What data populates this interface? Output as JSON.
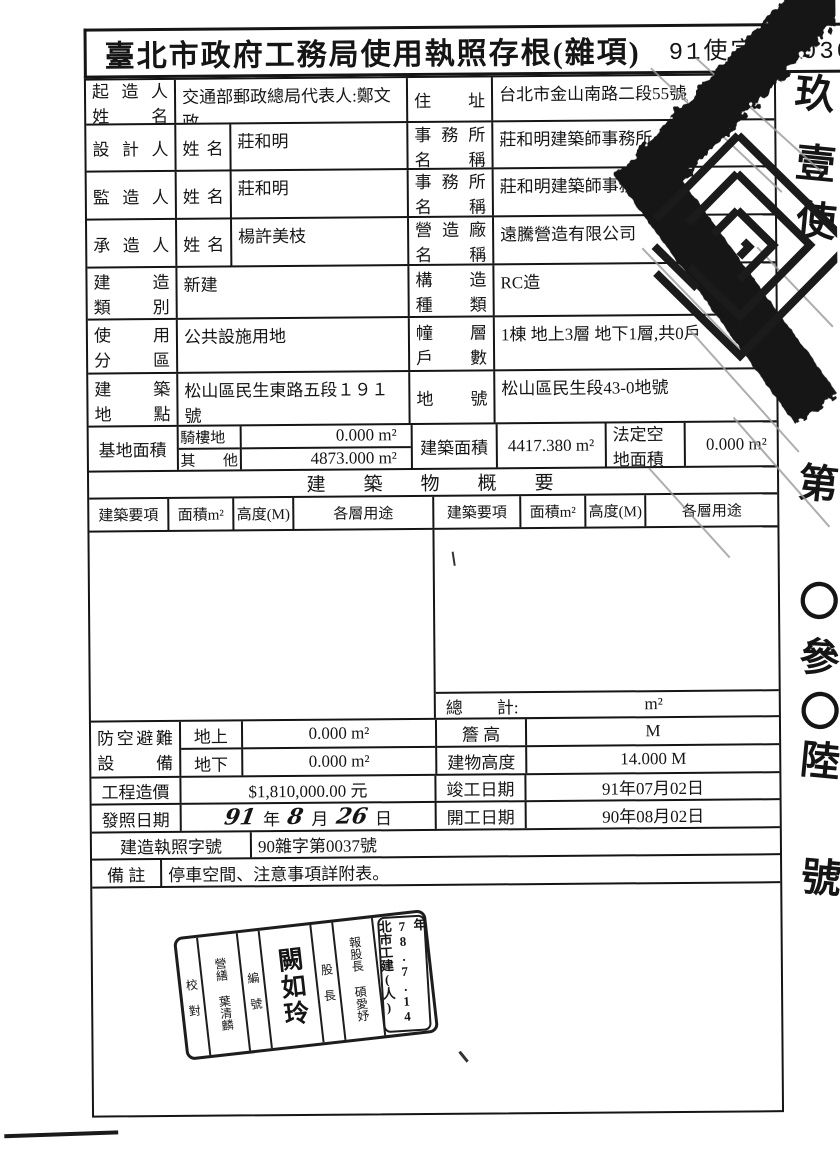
{
  "title": {
    "main": "臺北市政府工務局使用執照存根(雜項)",
    "number": "91使字第 0306 號"
  },
  "rows": {
    "owner": {
      "role": "起 造 人",
      "role2": "姓 名",
      "name": "交通部郵政總局代表人:鄭文政",
      "rlabel": "住 址",
      "rvalue": "台北市金山南路二段55號"
    },
    "designer": {
      "role": "設 計 人",
      "sub": "姓 名",
      "name": "莊和明",
      "rlabel1": "事 務 所",
      "rlabel2": "名 稱",
      "rvalue": "莊和明建築師事務所"
    },
    "supervisor": {
      "role": "監 造 人",
      "sub": "姓 名",
      "name": "莊和明",
      "rlabel1": "事 務 所",
      "rlabel2": "名 稱",
      "rvalue": "莊和明建築師事務所"
    },
    "contractor": {
      "role": "承 造 人",
      "sub": "姓 名",
      "name": "楊許美枝",
      "rlabel1": "營 造 廠",
      "rlabel2": "名 稱",
      "rvalue": "遠騰營造有限公司"
    },
    "build_class": {
      "l1": "建 造",
      "l2": "類 別",
      "value": "新建",
      "r1": "構 造",
      "r2": "種 類",
      "rvalue": "RC造"
    },
    "zoning": {
      "l1": "使 用",
      "l2": "分 區",
      "value": "公共設施用地",
      "r1": "幢 層",
      "r2": "戶 數",
      "rvalue": "1棟 地上3層 地下1層,共0戶"
    },
    "location": {
      "l1": "建 築",
      "l2": "地 點",
      "value": "松山區民生東路五段１９１號",
      "r1": "地 號",
      "rvalue": "松山區民生段43-0地號"
    },
    "site": {
      "label": "基地面積",
      "sub1": "騎樓地",
      "v1": "0.000 m²",
      "sub2": "其 他",
      "v2": "4873.000 m²",
      "blabel": "建築面積",
      "bvalue": "4417.380 m²",
      "flabel1": "法定空",
      "flabel2": "地面積",
      "fvalue": "0.000 m²"
    }
  },
  "summary": {
    "banner": "建築物概要",
    "headers": [
      "建築要項",
      "面積m²",
      "高度(M)",
      "各層用途",
      "建築要項",
      "面積m²",
      "高度(M)",
      "各層用途"
    ],
    "total_label": "總　　計:",
    "total_value": "m²"
  },
  "lower": {
    "air_raid": {
      "l1": "防空避難",
      "l2": "設 備",
      "sub1": "地上",
      "v1": "0.000 m²",
      "sub2": "地下",
      "v2": "0.000 m²"
    },
    "eave": {
      "label": "簷 高",
      "value": "M"
    },
    "height": {
      "label": "建物高度",
      "value": "14.000 M"
    },
    "cost": {
      "label": "工程造價",
      "value": "$1,810,000.00 元"
    },
    "complete": {
      "label": "竣工日期",
      "value": "91年07月02日"
    },
    "issue": {
      "label": "發照日期",
      "y": "91",
      "yl": "年",
      "m": "8",
      "ml": "月",
      "d": "26",
      "dl": "日"
    },
    "start": {
      "label": "開工日期",
      "value": "90年08月02日"
    },
    "permit": {
      "label": "建造執照字號",
      "value": "90雜字第0037號"
    },
    "note": {
      "label": "備 註",
      "value": "停車空間、注意事項詳附表。"
    }
  },
  "stamp": {
    "columns": [
      "校 對",
      "營繕 葉清麟",
      "編 號",
      "闕如玲",
      "股 長",
      "報股長 碩愛妤"
    ],
    "date": "年78.7.14北市工建(人)"
  },
  "margin": {
    "chars": [
      "玖",
      "壹",
      "使",
      "第",
      "〇",
      "參",
      "〇",
      "陸",
      "號"
    ]
  },
  "ink": {
    "color": "#151515"
  }
}
